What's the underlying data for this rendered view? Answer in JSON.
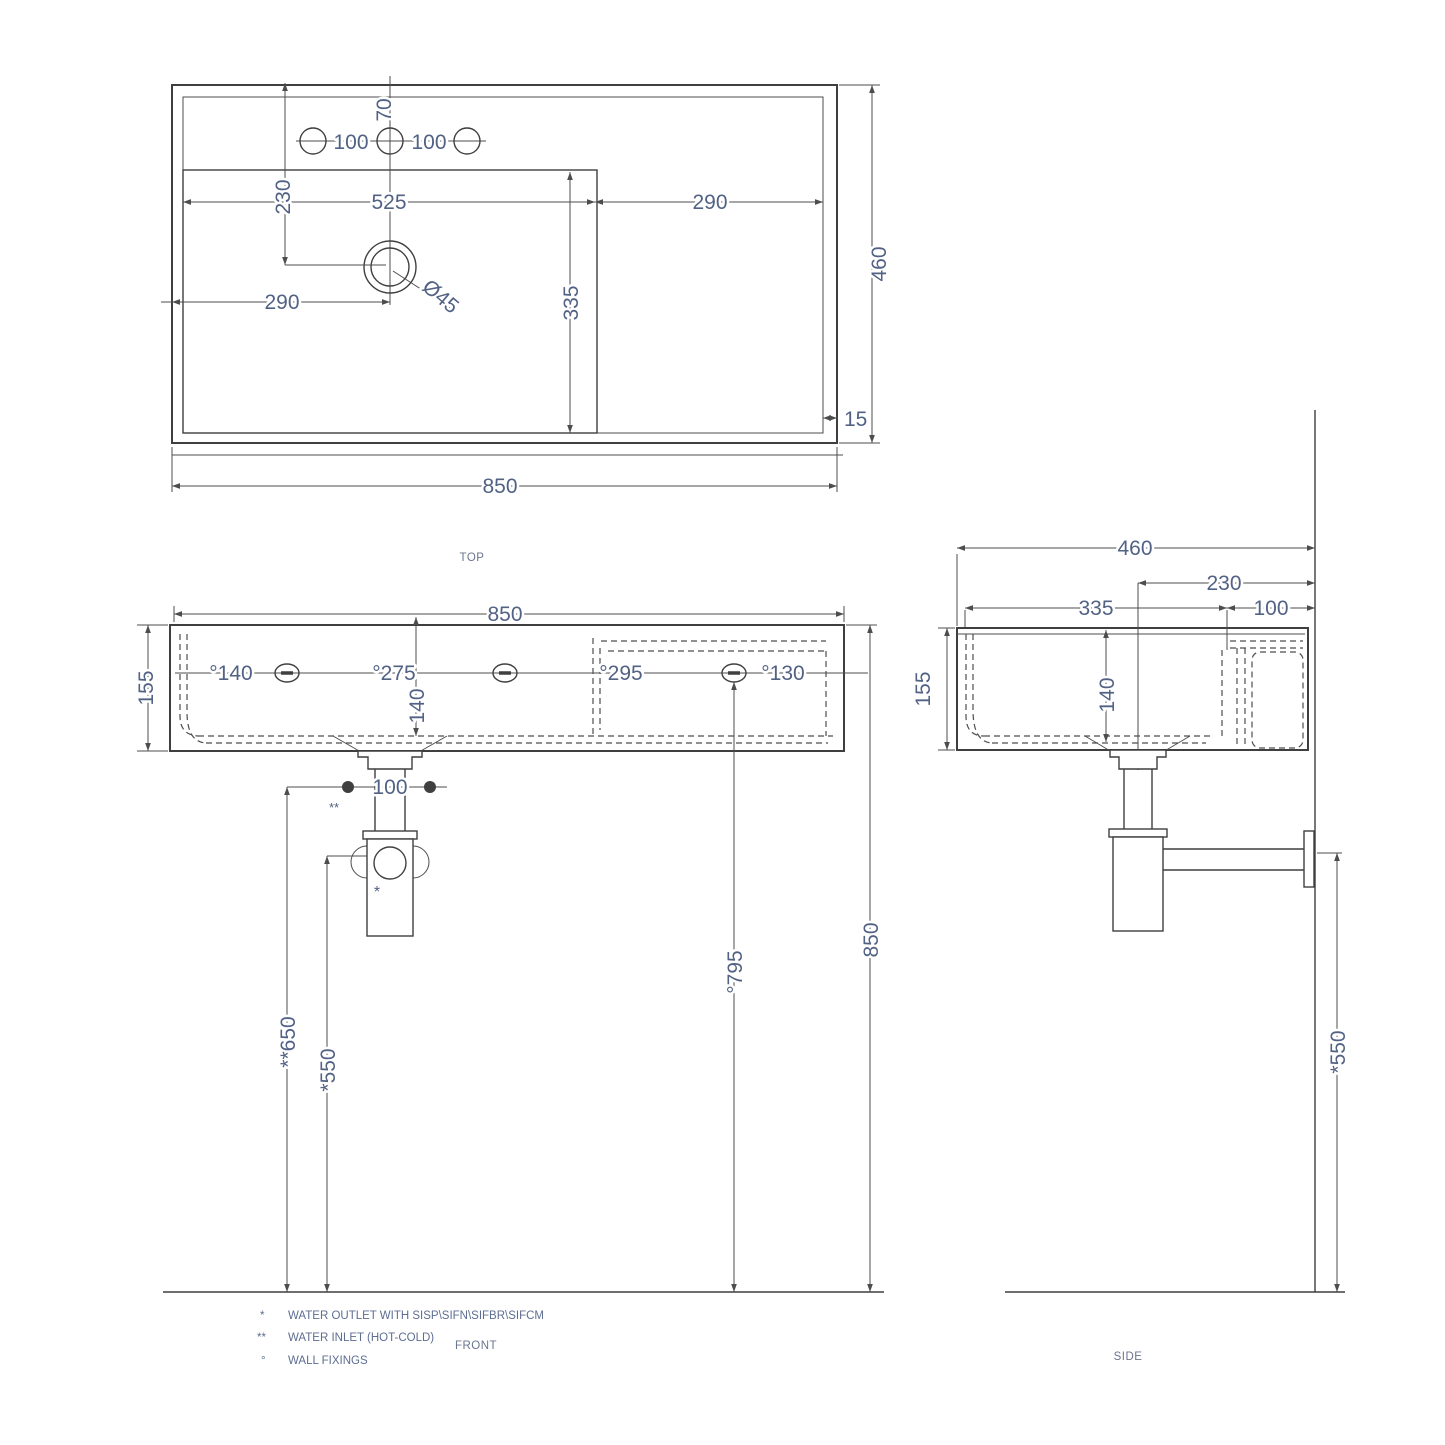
{
  "page": {
    "background": "#ffffff",
    "line_color": "#3f3f3f",
    "dimension_text_color": "#526285"
  },
  "views": {
    "top": {
      "label": "TOP",
      "dims": {
        "overall_width": "850",
        "overall_depth": "460",
        "holes_offset": "70",
        "hole_spacing_left": "100",
        "hole_spacing_right": "100",
        "drain_offset_top": "230",
        "bowl_width": "525",
        "deck_width": "290",
        "drain_offset_left": "290",
        "bowl_depth": "335",
        "drain_diameter": "Ø45",
        "rim_inset": "15"
      }
    },
    "front": {
      "label": "FRONT",
      "dims": {
        "overall_width": "850",
        "height": "155",
        "fixing_left": "°140",
        "fixing_center": "°275",
        "recess_width": "°295",
        "fixing_right": "°130",
        "bowl_inner_height": "140",
        "inlet_spacing": "100",
        "inlet_marker": "**",
        "outlet_marker": "*",
        "inlet_height": "**650",
        "outlet_height": "*550",
        "fixing_height": "°795",
        "rim_height": "850"
      }
    },
    "side": {
      "label": "SIDE",
      "dims": {
        "overall_depth": "460",
        "drain_offset_wall": "230",
        "bowl_depth": "335",
        "fixing_offset_wall": "100",
        "height": "155",
        "bowl_inner_height": "140",
        "outlet_height": "*550"
      }
    }
  },
  "legend": {
    "items": [
      {
        "marker": "*",
        "text": "WATER OUTLET WITH SISP\\SIFN\\SIFBR\\SIFCM"
      },
      {
        "marker": "**",
        "text": "WATER INLET  (HOT-COLD)"
      },
      {
        "marker": "°",
        "text": "WALL FIXINGS"
      }
    ]
  }
}
